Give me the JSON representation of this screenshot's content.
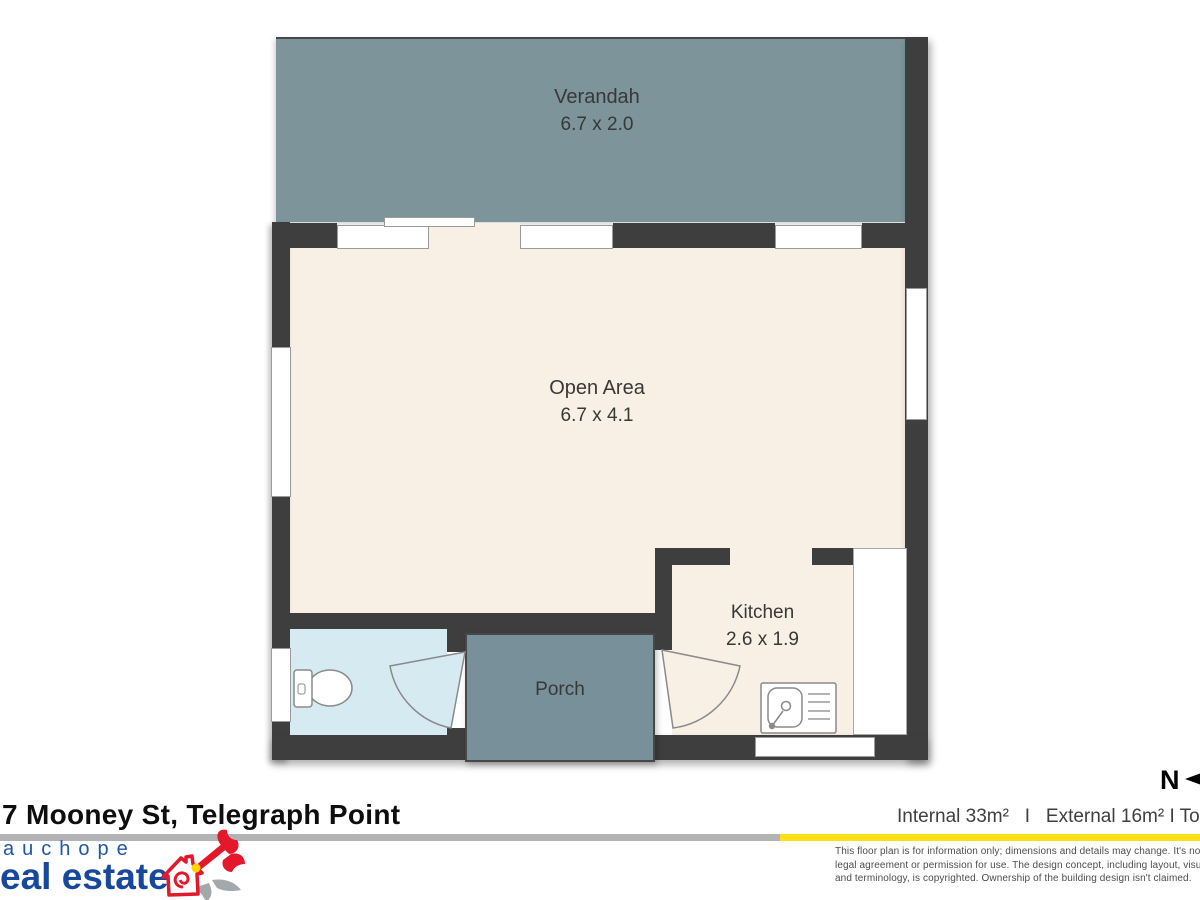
{
  "header": {
    "address": "7 Mooney St, Telegraph Point"
  },
  "north": {
    "label": "N"
  },
  "areas": {
    "summary": "Internal 33m²   I   External 16m² I Total 49m²"
  },
  "rooms": {
    "verandah": {
      "label": "Verandah",
      "dims": "6.7 x 2.0"
    },
    "open_area": {
      "label": "Open Area",
      "dims": "6.7 x 4.1"
    },
    "kitchen": {
      "label": "Kitchen",
      "dims": "2.6 x 1.9"
    },
    "porch": {
      "label": "Porch"
    }
  },
  "disclaimer": {
    "line1": "This floor plan is for information only; dimensions and details may change. It's not a",
    "line2": "legal agreement or permission for use. The design concept, including layout, visuals,",
    "line3": "and terminology, is copyrighted. Ownership of the building design isn't claimed."
  },
  "logo": {
    "line1": "auchope",
    "line2": "eal estate"
  },
  "colors": {
    "wall": "#3e3e3e",
    "verandah": "#7c949a",
    "porch": "#78909a",
    "floor_cream": "#f8f0e5",
    "bathroom_blue": "#d6eaf2",
    "divider_gray": "#b3b3b5",
    "accent_yellow": "#ffdf17",
    "logo_blue": "#17489c"
  }
}
